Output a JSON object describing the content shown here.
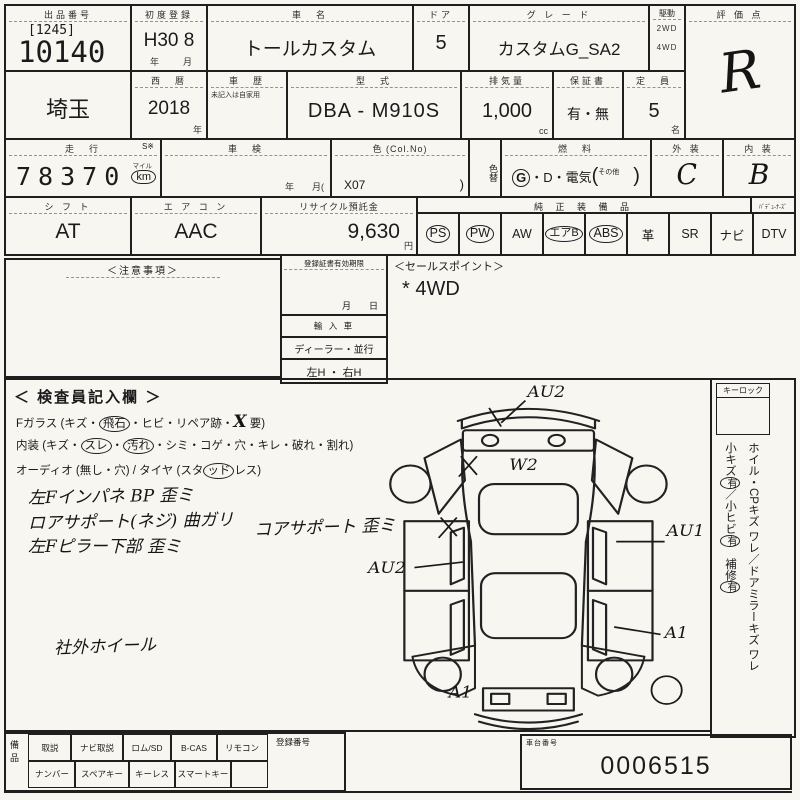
{
  "row1": {
    "lot_label": "出品番号",
    "lot_bracket": "[1245]",
    "lot_number": "10140",
    "first_reg_label": "初度登録",
    "first_reg_value": "H30 8",
    "first_reg_year_unit": "年",
    "first_reg_month_unit": "月",
    "name_label": "車　名",
    "name_value": "トールカスタム",
    "door_label": "ドア",
    "door_value": "5",
    "grade_label": "グ レ ー ド",
    "grade_value": "カスタムG_SA2",
    "drive_label": "駆動",
    "drive_2wd": "2WD",
    "drive_4wd": "4WD",
    "score_label": "評 価 点",
    "score_value": "R"
  },
  "row2": {
    "region_value": "埼玉",
    "calendar_label": "西　暦",
    "calendar_value": "2018",
    "calendar_unit": "年",
    "history_label": "車　歴",
    "history_note": "未記入は自家用",
    "model_label": "型　式",
    "model_value": "DBA - M910S",
    "displacement_label": "排気量",
    "displacement_value": "1,000",
    "displacement_unit": "cc",
    "warranty_label": "保証書",
    "warranty_value": "有・無",
    "capacity_label": "定　員",
    "capacity_value": "5",
    "capacity_unit": "名"
  },
  "row3": {
    "mileage_label": "走　行",
    "mileage_flag": "S※",
    "mileage_value": "78370",
    "mileage_unit_small": "マイル",
    "mileage_unit": "km",
    "inspection_label": "車　検",
    "inspection_units": "年　　月(",
    "color_label": "色 (Col.No)",
    "color_value": "X07",
    "color_paren": ")",
    "color_change_label": "色替",
    "fuel_label": "燃　料",
    "fuel_gas": "G",
    "fuel_mid": "・D・電気",
    "fuel_open": "(",
    "fuel_other": "その他",
    "fuel_close": ")",
    "exterior_label": "外 装",
    "exterior_value": "C",
    "interior_label": "内 装",
    "interior_value": "B"
  },
  "row4": {
    "shift_label": "シ フ ト",
    "shift_value": "AT",
    "aircon_label": "エ ア コ ン",
    "aircon_value": "AAC",
    "recycle_label": "リサイクル預託金",
    "recycle_value": "9,630",
    "recycle_unit": "円",
    "equipment_label": "純 正 装 備 品",
    "equipment_corner": "ﾊﾞﾃﾞｭ-ﾅ-ｽﾞ",
    "equipment": [
      {
        "label": "PS",
        "circled": true
      },
      {
        "label": "PW",
        "circled": true
      },
      {
        "label": "AW",
        "circled": false
      },
      {
        "label": "エアB",
        "circled": true
      },
      {
        "label": "ABS",
        "circled": true
      },
      {
        "label": "革",
        "circled": false
      },
      {
        "label": "SR",
        "circled": false
      },
      {
        "label": "ナビ",
        "circled": false
      },
      {
        "label": "DTV",
        "circled": false
      }
    ]
  },
  "middle": {
    "notes_label": "＜注意事項＞",
    "registration_label": "登録証書有効期限",
    "registration_units": "月　　日",
    "import_label": "輸 入 車",
    "import_type": "ディーラー・並行",
    "handle_options": "左H ・ 右H",
    "sales_label": "＜セールスポイント＞",
    "sales_value": "* 4WD"
  },
  "inspector": {
    "title": "＜ 検査員記入欄 ＞",
    "glass_prefix": "Fガラス (キズ・",
    "glass_circled": "飛石",
    "glass_mid": "・ヒビ・リペア跡・",
    "glass_x": "X",
    "glass_suffix": "要)",
    "interior_prefix": "内装 (キズ・",
    "interior_c1": "スレ",
    "interior_dot": "・",
    "interior_c2": "汚れ",
    "interior_suffix": "・シミ・コゲ・穴・キレ・破れ・割れ)",
    "audio_prefix": "オーディオ (無し・穴) / タイヤ (スタ",
    "audio_circled": "ッド",
    "audio_suffix": "レス)",
    "notes": [
      "左Fインパネ BP 歪ミ",
      "ロアサポート(ネジ) 曲ガリ",
      "コアサポート 歪ミ",
      "左Fピラー下部 歪ミ",
      "社外ホイール"
    ],
    "marks": {
      "front_bumper": "AU2",
      "hood": "W2",
      "right_front_door": "AU1",
      "left_rear_door": "AU2",
      "right_rear_quarter": "A1",
      "rear_bumper": "A1"
    }
  },
  "sidebar": {
    "keylock_label": "キーロック",
    "line1": "ホイル・CPキズ ワレ／ドアミラーキズ ワレ",
    "items": [
      {
        "text": "小キズ",
        "mark": "有"
      },
      {
        "text": "小ヒビ",
        "mark": "有"
      },
      {
        "text": "補修",
        "mark": "有"
      }
    ]
  },
  "footer": {
    "equip_label": "備品",
    "row1": [
      "取説",
      "ナビ取説",
      "ロム/SD",
      "B-CAS",
      "リモコン"
    ],
    "reg_no_label": "登録番号",
    "row2": [
      "ナンバー",
      "スペアキー",
      "キーレス",
      "スマートキー"
    ],
    "chassis_label": "車台番号",
    "chassis_value": "0006515"
  }
}
